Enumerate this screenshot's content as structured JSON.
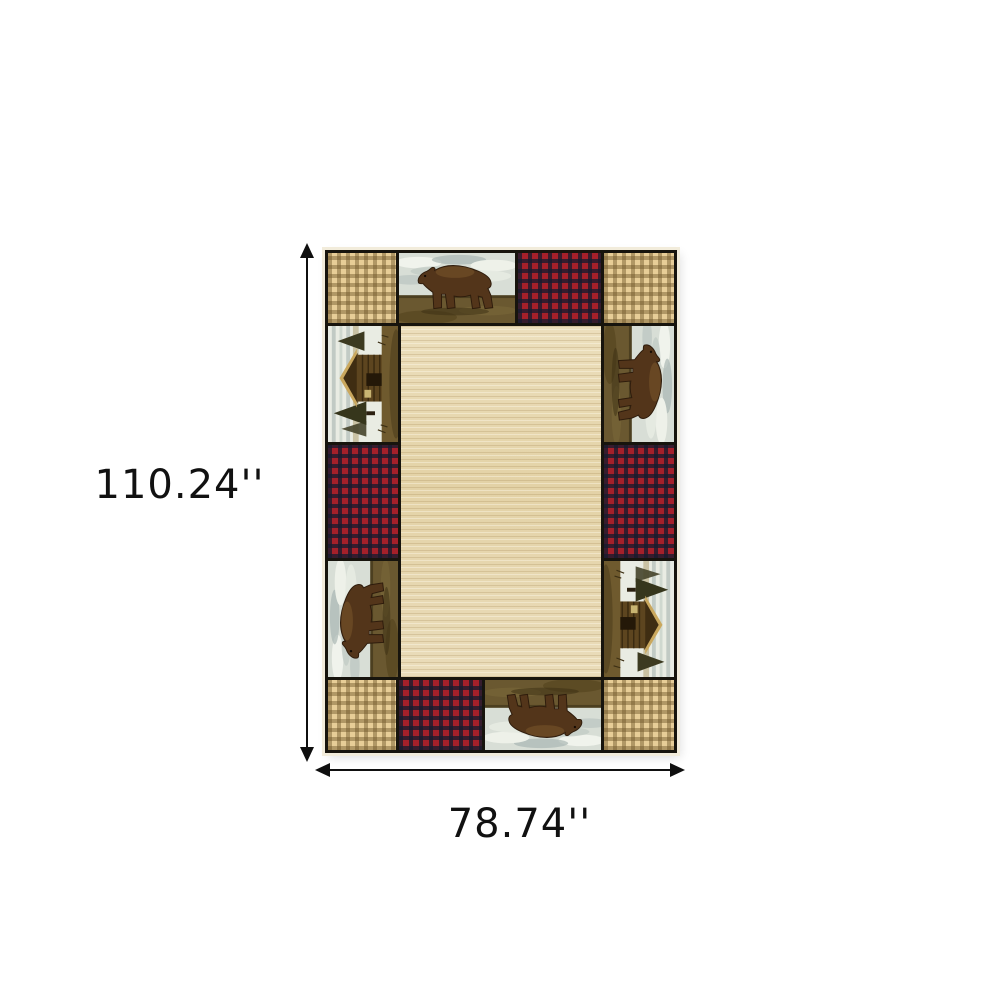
{
  "page": {
    "type": "product-dimension-diagram",
    "background": "#ffffff"
  },
  "product": {
    "name": "rustic-lodge-patchwork-area-rug",
    "description": "Rectangular area rug with a patchwork border of walking-bear scenes, log-cabin scenes, red buffalo plaid and tan gingham squares surrounding a beige heathered center field"
  },
  "dimensions": {
    "height_label": "110.24''",
    "width_label": "78.74''"
  },
  "icons": {
    "bear_scene": "walking-bear-scene",
    "cabin_scene": "log-cabin-scene",
    "red_plaid": "red-buffalo-plaid-swatch",
    "tan_plaid": "tan-gingham-plaid-swatch",
    "arrows": "double-headed-dimension-arrows"
  },
  "colors": {
    "annotation": "#111111",
    "rug_grid_black": "#17140d",
    "rug_edge_cream": "#f2ecdb",
    "plaid_tan_base": "#e7cd97",
    "plaid_tan_stripe": "#6d5528",
    "plaid_red_base": "#a5202a",
    "plaid_red_stripe": "#171b2e",
    "field_beige": "#e8d9b4",
    "bear_brown": "#53351a",
    "scene_sky": "#d8ded6",
    "scene_ground": "#6a5830"
  }
}
